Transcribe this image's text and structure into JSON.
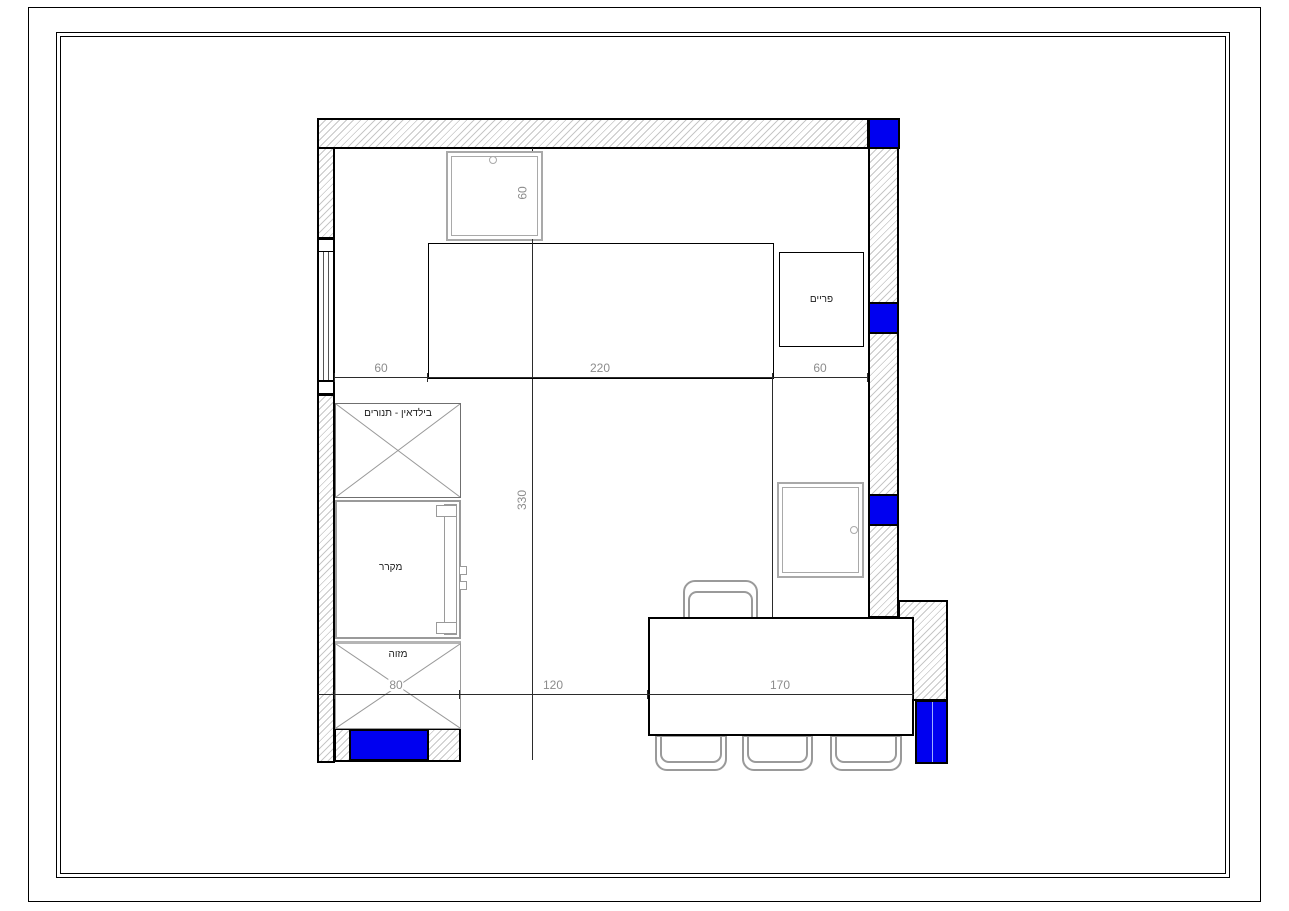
{
  "plan": {
    "labels": {
      "builtin_ovens": "בילדאין - תנורים",
      "refrigerator": "מקרר",
      "pantry": "מזוה",
      "corner_cabinet": "פריים"
    },
    "dims": {
      "top": [
        "60",
        "220",
        "60"
      ],
      "bottom": [
        "80",
        "120",
        "170"
      ],
      "height": "330",
      "sink": "60"
    },
    "colors": {
      "accent_blue": "#0000f0",
      "hatch_line": "#c7c7c7",
      "wall_outline": "#000000",
      "dim_text": "#8c8c8c"
    }
  }
}
